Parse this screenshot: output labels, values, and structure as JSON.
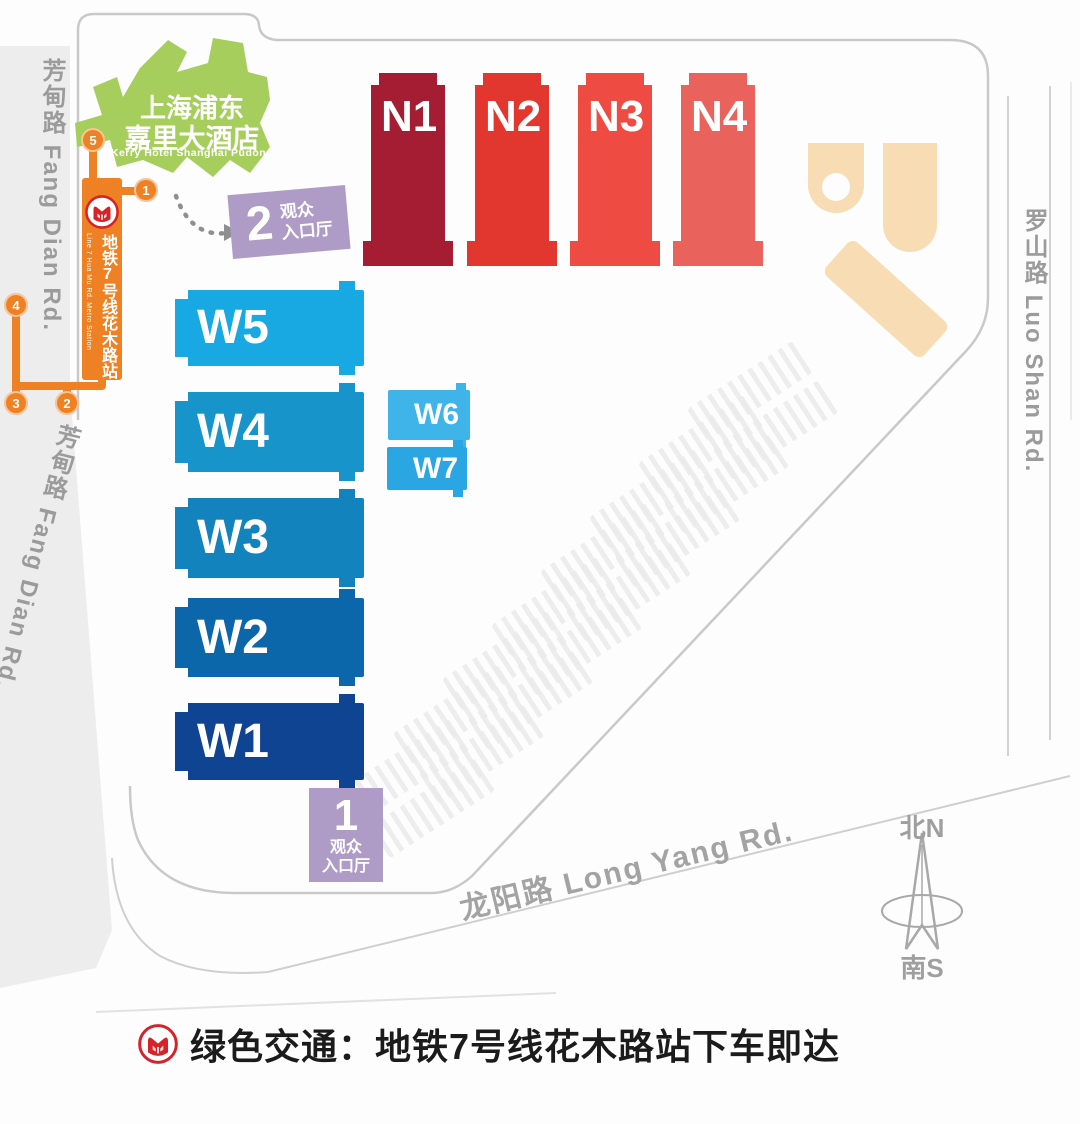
{
  "map": {
    "hotel": {
      "name_zh_line1": "上海浦东",
      "name_zh_line2": "嘉里大酒店",
      "name_en": "Kerry Hotel Shanghai Pudong",
      "color": "#A5CE5D"
    },
    "metro": {
      "station_zh": "地铁7号线花木路站",
      "station_en": "Line 7 Hua Mu Rd. Metro Station",
      "line_color": "#EE8124",
      "stops": [
        "5",
        "1",
        "4",
        "3",
        "2"
      ]
    },
    "entrances": [
      {
        "num": "2",
        "line1": "观众",
        "line2": "入口厅"
      },
      {
        "num": "1",
        "line1": "观众",
        "line2": "入口厅"
      }
    ],
    "entrance_color": "#AF9CC6",
    "halls": {
      "north": [
        {
          "id": "N1",
          "color": "#A51D32"
        },
        {
          "id": "N2",
          "color": "#E2372F"
        },
        {
          "id": "N3",
          "color": "#EE4B42"
        },
        {
          "id": "N4",
          "color": "#EA625C"
        }
      ],
      "west": [
        {
          "id": "W5",
          "color": "#18A8E2"
        },
        {
          "id": "W4",
          "color": "#1794CA"
        },
        {
          "id": "W3",
          "color": "#1283BC"
        },
        {
          "id": "W2",
          "color": "#0C66AA"
        },
        {
          "id": "W1",
          "color": "#0F4492"
        },
        {
          "id": "W6",
          "color": "#3FB4E9"
        },
        {
          "id": "W7",
          "color": "#2AA7E2"
        }
      ]
    },
    "buildings_color": "#F8DCB4",
    "roads": {
      "fang_dian": "芳甸路 Fang Dian Rd.",
      "fang_dian_2": "芳甸路 Fang Dian Rd.",
      "luo_shan": "罗山路 Luo Shan Rd.",
      "long_yang": "龙阳路 Long Yang Rd."
    },
    "compass": {
      "north": "北N",
      "south": "南S"
    }
  },
  "legend": {
    "text": "绿色交通：地铁7号线花木路站下车即达"
  }
}
